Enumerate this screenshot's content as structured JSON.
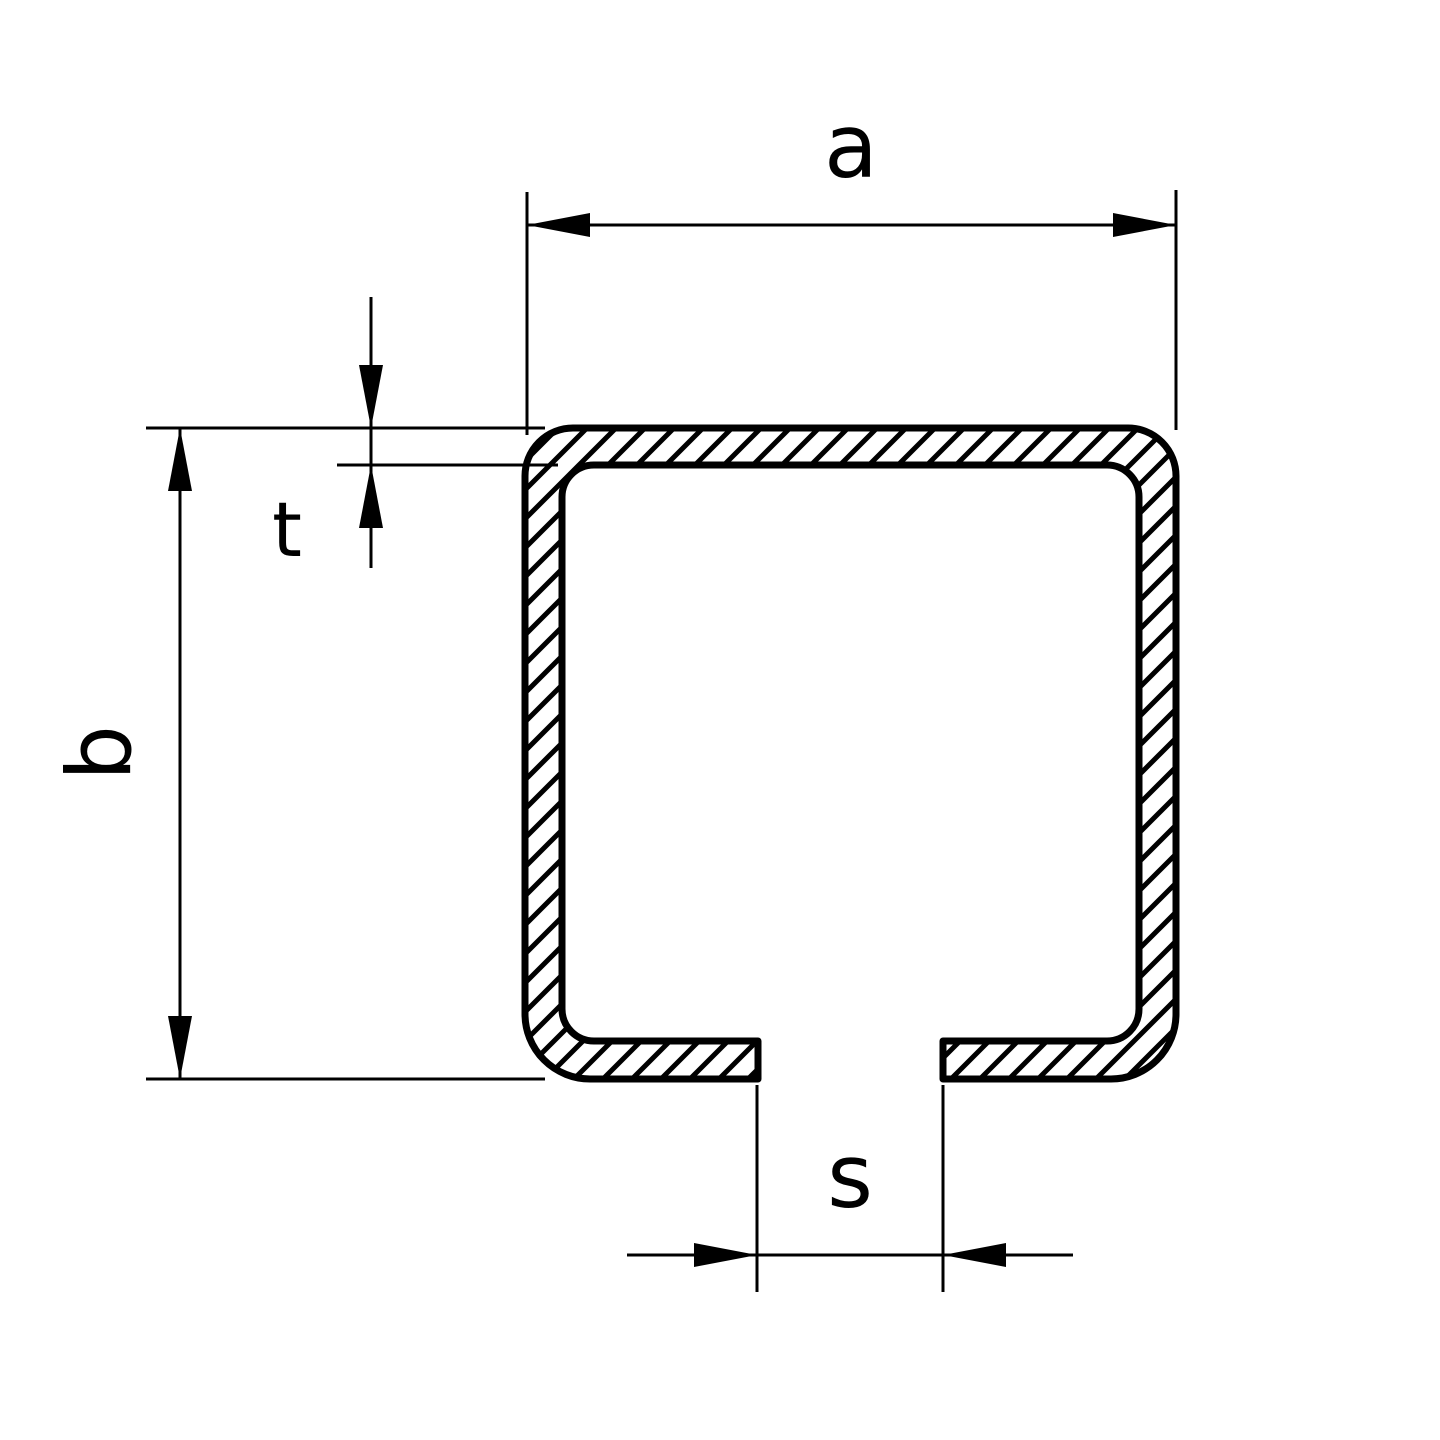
{
  "drawing": {
    "kind": "technical-drawing-cross-section",
    "subject": "c-channel-profile",
    "colors": {
      "line": "#000000",
      "background": "#ffffff"
    },
    "labels": {
      "width": "a",
      "height": "b",
      "thickness": "t",
      "slot_width": "s"
    }
  }
}
